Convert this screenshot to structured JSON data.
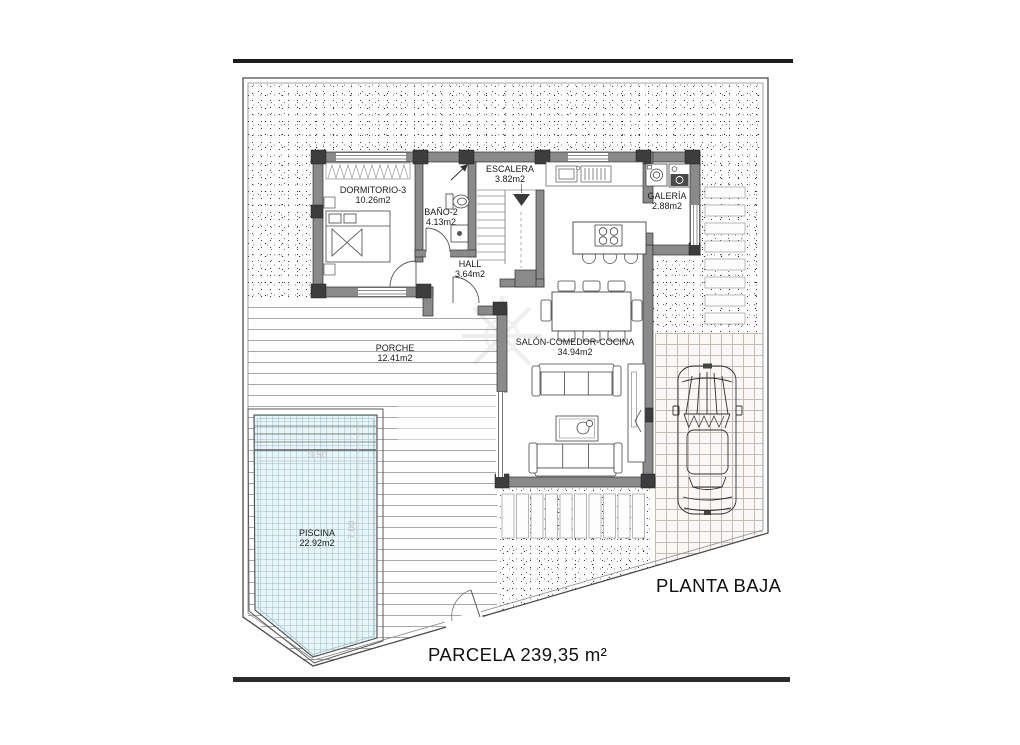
{
  "title_block": {
    "floor_label": "PLANTA BAJA",
    "parcel_label": "PARCELA 239,35 m²"
  },
  "rooms": [
    {
      "name": "DORMITORIO-3",
      "area": "10.26m2"
    },
    {
      "name": "BAÑO-2",
      "area": "4.13m2"
    },
    {
      "name": "ESCALERA",
      "area": "3.82m2"
    },
    {
      "name": "HALL",
      "area": "3.64m2"
    },
    {
      "name": "GALERÍA",
      "area": "2.88m2"
    },
    {
      "name": "SALÓN-COMEDOR-COCINA",
      "area": "34.94m2"
    },
    {
      "name": "PORCHE",
      "area": "12.41m2"
    },
    {
      "name": "PISCINA",
      "area": "22.92m2"
    }
  ],
  "pool_dimensions": {
    "width": "3.50",
    "length": "7.00"
  },
  "colors": {
    "wall": "#8a8a8a",
    "pillar": "#3d3d3d",
    "pool_water": "#e9f5f7",
    "drawing_line": "#333333"
  }
}
